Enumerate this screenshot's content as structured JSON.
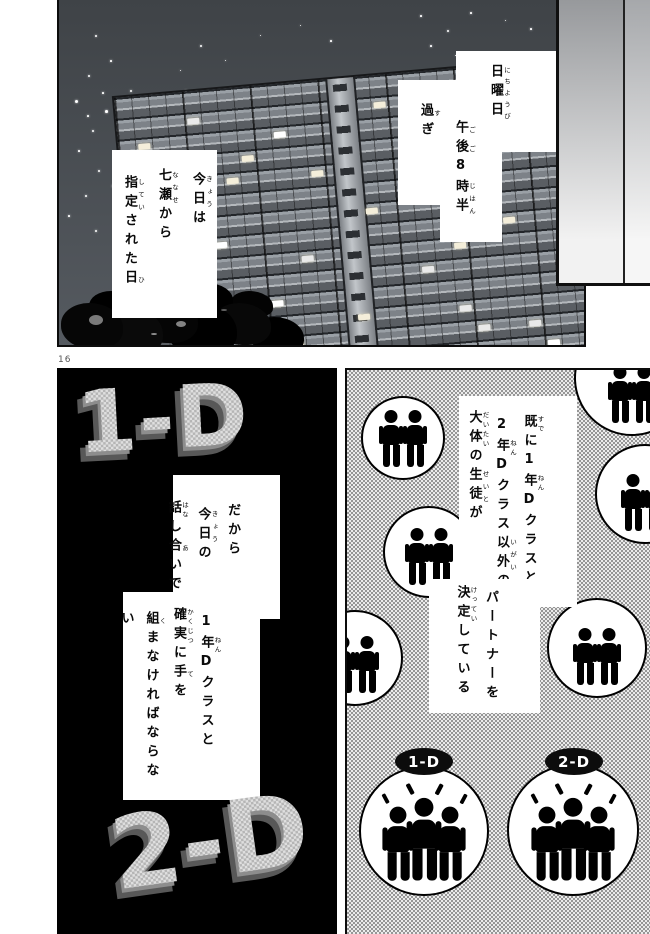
{
  "page": {
    "number": "16"
  },
  "colors": {
    "sky": "#474b50",
    "panel_black": "#000000",
    "halftone_dark": "#969696",
    "halftone_light": "#ececec",
    "badge_bg": "#0c0c0c",
    "letters_face": "#cbcbcb",
    "letters_side": "#585858"
  },
  "top_panel": {
    "bubble_time": {
      "lines": [
        [
          [
            "日曜日",
            "にちようび"
          ]
        ],
        [
          [
            "午後",
            "ごご"
          ],
          [
            "8",
            null
          ],
          [
            "時半",
            "じはん"
          ]
        ],
        [
          [
            "過",
            "す"
          ],
          [
            "ぎ",
            null
          ]
        ]
      ]
    },
    "bubble_today": {
      "lines": [
        [
          [
            "今日",
            "きょう"
          ],
          [
            "は",
            null
          ]
        ],
        [
          [
            "七瀬",
            "ななせ"
          ],
          [
            "から",
            null
          ]
        ],
        [
          [
            "指定",
            "してい"
          ],
          [
            "された",
            null
          ],
          [
            "日",
            "ひ"
          ]
        ]
      ]
    }
  },
  "left_panel": {
    "class_label_top": "1-D",
    "class_label_bottom": "2-D",
    "bubble_discussion": {
      "lines": [
        [
          [
            "だから",
            null
          ]
        ],
        [
          [
            "今日",
            "きょう"
          ],
          [
            "の",
            null
          ]
        ],
        [
          [
            "話",
            "はな"
          ],
          [
            "し",
            null
          ],
          [
            "合",
            "あ"
          ],
          [
            "いで",
            null
          ]
        ]
      ]
    },
    "bubble_alliance": {
      "lines": [
        [
          [
            "1",
            null
          ],
          [
            "年",
            "ねん"
          ],
          [
            "Dクラスと",
            null
          ]
        ],
        [
          [
            "確実",
            "かくじつ"
          ],
          [
            "に",
            null
          ],
          [
            "手",
            "て"
          ],
          [
            "を",
            null
          ]
        ],
        [
          [
            "組",
            "く"
          ],
          [
            "まなければならない",
            null
          ]
        ]
      ]
    }
  },
  "right_panel": {
    "bubble_status": {
      "lines": [
        [
          [
            "既",
            "すで"
          ],
          [
            "に1",
            null
          ],
          [
            "年",
            "ねん"
          ],
          [
            "Dクラスと",
            null
          ]
        ],
        [
          [
            "2",
            null
          ],
          [
            "年",
            "ねん"
          ],
          [
            "Dクラス",
            null
          ],
          [
            "以外",
            "いがい"
          ],
          [
            "の",
            null
          ]
        ],
        [
          [
            "大体",
            "だいたい"
          ],
          [
            "の",
            null
          ],
          [
            "生徒",
            "せいと"
          ],
          [
            "が",
            null
          ]
        ]
      ]
    },
    "bubble_partner": {
      "lines": [
        [
          [
            "パートナーを",
            null
          ]
        ],
        [
          [
            "決定",
            "けってい"
          ],
          [
            "している",
            null
          ]
        ]
      ]
    },
    "badge_left": "1-D",
    "badge_right": "2-D"
  }
}
